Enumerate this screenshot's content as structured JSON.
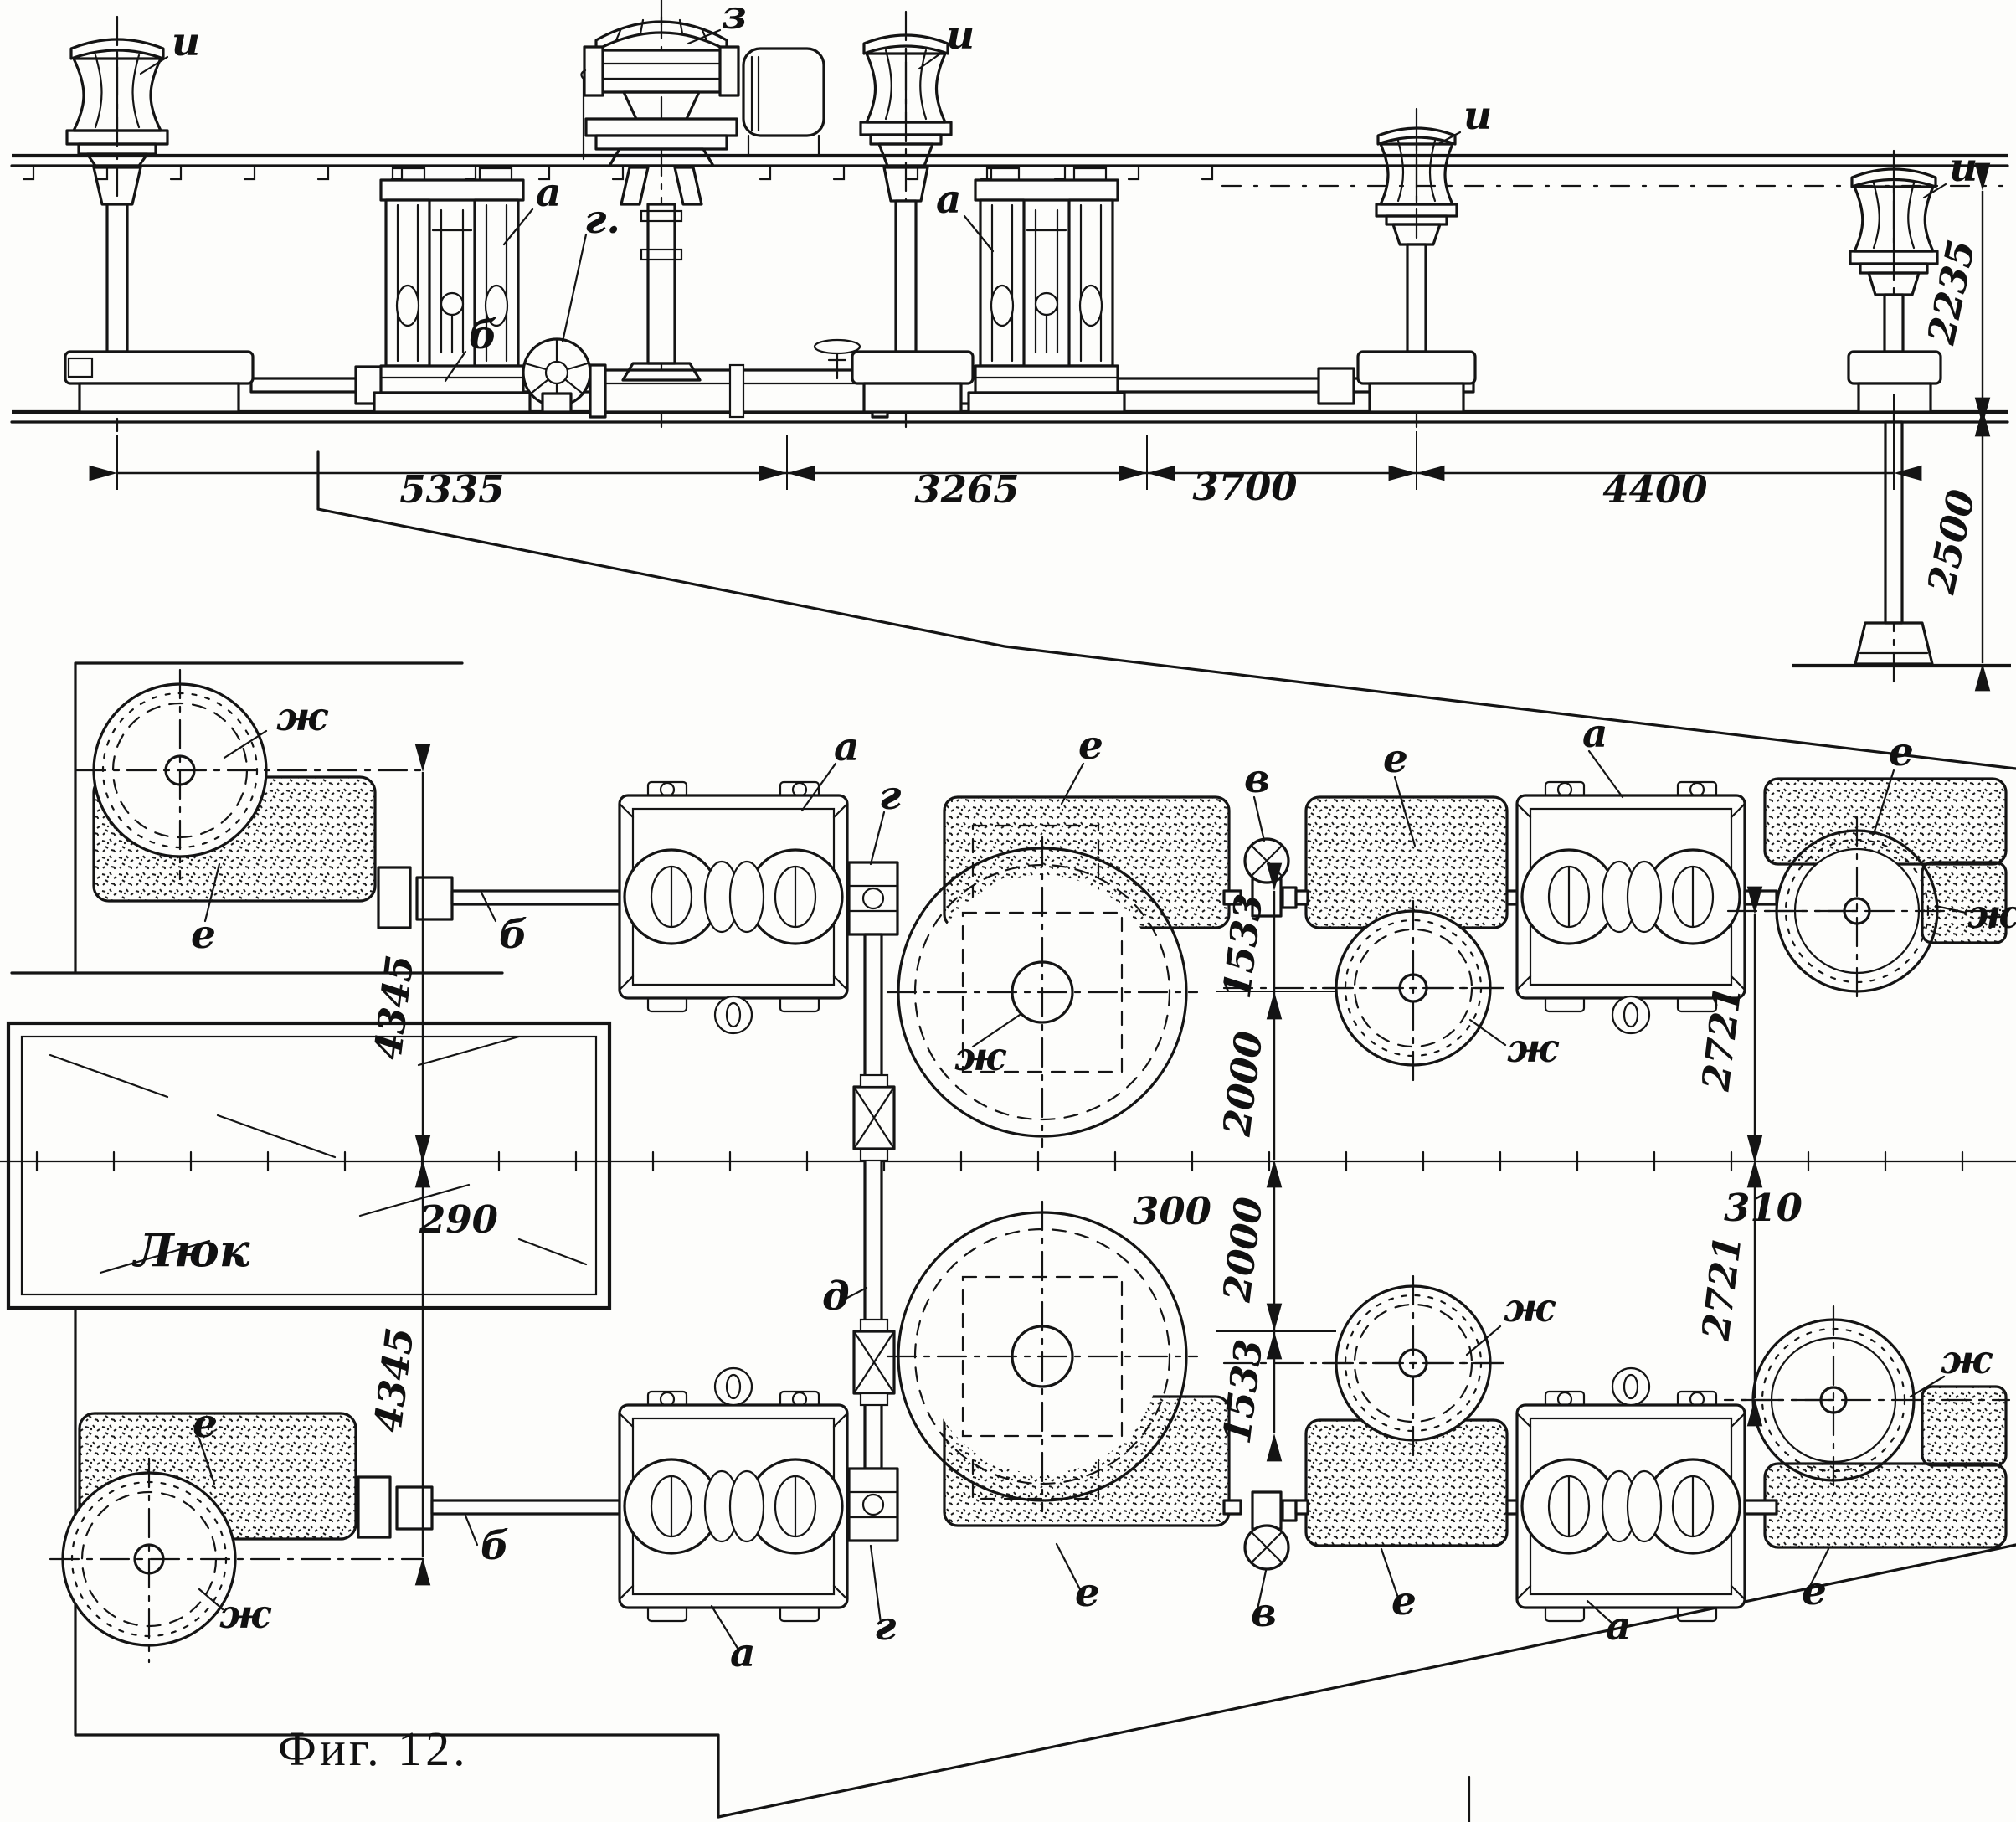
{
  "caption": "Фиг. 12.",
  "hatch": {
    "label": "Люк"
  },
  "elevation": {
    "labels": {
      "i1": "и",
      "i2": "и",
      "i3": "и",
      "i4": "и",
      "z": "з",
      "a1": "а",
      "a2": "а",
      "b": "б",
      "g": "г."
    },
    "dimensions": {
      "d1": "5335",
      "d2": "3265",
      "d3": "3700",
      "d4": "4400",
      "h1": "2235",
      "h2": "2500"
    }
  },
  "plan": {
    "labels": {
      "zh_ul": "ж",
      "e_ul": "е",
      "b1": "б",
      "a1": "а",
      "g1": "г",
      "e_wu": "е",
      "zh_wu": "ж",
      "d": "д",
      "v1": "в",
      "e_mu": "е",
      "zh_mu": "ж",
      "a2": "а",
      "e_ru": "е",
      "zh_ru": "ж",
      "e_ll": "е",
      "zh_ll": "ж",
      "b2": "б",
      "a3": "а",
      "g2": "г",
      "e_wl": "е",
      "v2": "в",
      "e_ml": "е",
      "zh_ml": "ж",
      "a4": "а",
      "e_rl": "е",
      "zh_rl": "ж"
    },
    "dimensions": {
      "off1": "4345",
      "off2": "4345",
      "r1": "1533",
      "r2": "2000",
      "r3": "2000",
      "r4": "1533",
      "rt1": "2721",
      "rt2": "2721",
      "c1": "290",
      "c2": "300",
      "c3": "310"
    }
  }
}
